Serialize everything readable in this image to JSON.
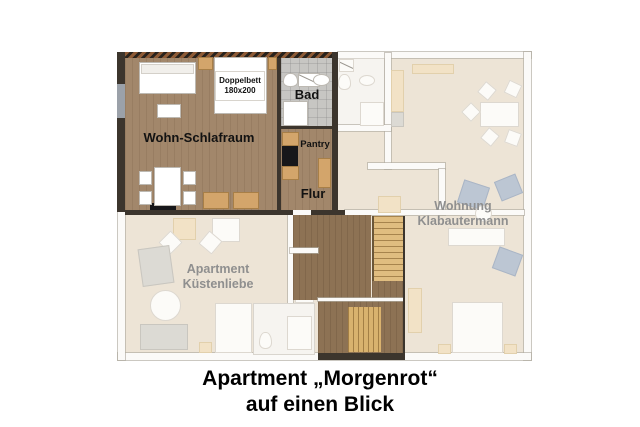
{
  "plan": {
    "rooms": {
      "wohn_schlafraum": "Wohn-Schlafraum",
      "doppelbett_line1": "Doppelbett",
      "doppelbett_line2": "180x200",
      "bad": "Bad",
      "pantry": "Pantry",
      "flur": "Flur"
    },
    "neighbors": {
      "wohnung_line1": "Wohnung",
      "wohnung_line2": "Klabautermann",
      "apartment_line1": "Apartment",
      "apartment_line2": "Küstenliebe"
    }
  },
  "caption": {
    "line1": "Apartment „Morgenrot“",
    "line2": "auf einen Blick"
  },
  "colors": {
    "wood": "#a2876b",
    "wood_dark": "#8d7254",
    "stair": "#e0bd80",
    "tile": "#c7c6c3",
    "faded_floor": "#ede4d6",
    "tan": "#d3a56b",
    "blue": "#bcc6d3",
    "wall_dark": "#3c352d",
    "hatch": "#8d5a35",
    "label_gray": "#8f8f8f"
  }
}
